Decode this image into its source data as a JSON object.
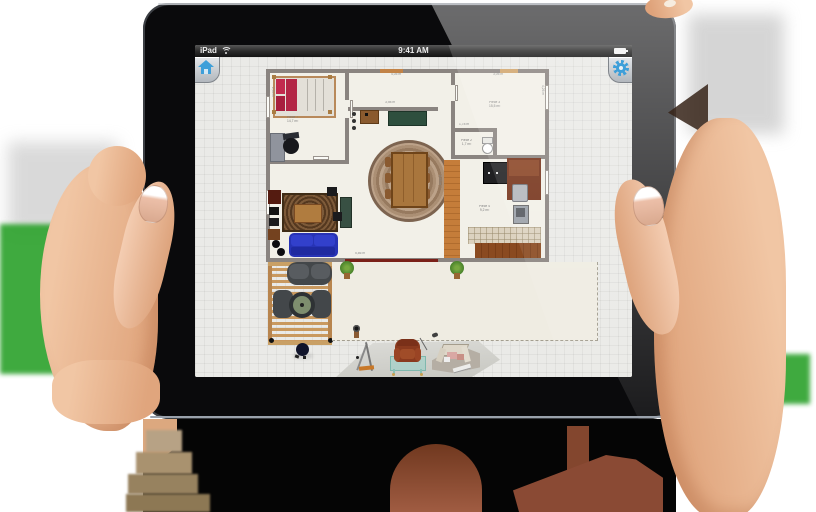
{
  "app": {
    "status_bar": {
      "carrier": "iPad",
      "time": "9:41 AM"
    },
    "rooms": [
      {
        "name": "bedroom",
        "label": "Pièce 7",
        "area": "14,7 m²"
      },
      {
        "name": "room-3",
        "label": "Pièce 3",
        "area": "15,5 m²"
      },
      {
        "name": "bathroom",
        "label": "Pièce 2",
        "area": "1,7 m²"
      },
      {
        "name": "kitchen",
        "label": "Pièce 4",
        "area": "9,2 m²"
      }
    ],
    "dimensions": [
      "4,05 m",
      "3,98 m",
      "3,05 m",
      "2,90 m",
      "4,26 m",
      "5,86 m",
      "1,78 m",
      "2,43 m",
      "5,20 m"
    ],
    "colors": {
      "accent_blue": "#3e9fd9",
      "wall_gray": "#8a8480",
      "sofa_blue": "#2733b5",
      "chroma_green": "#2fa32f"
    }
  }
}
